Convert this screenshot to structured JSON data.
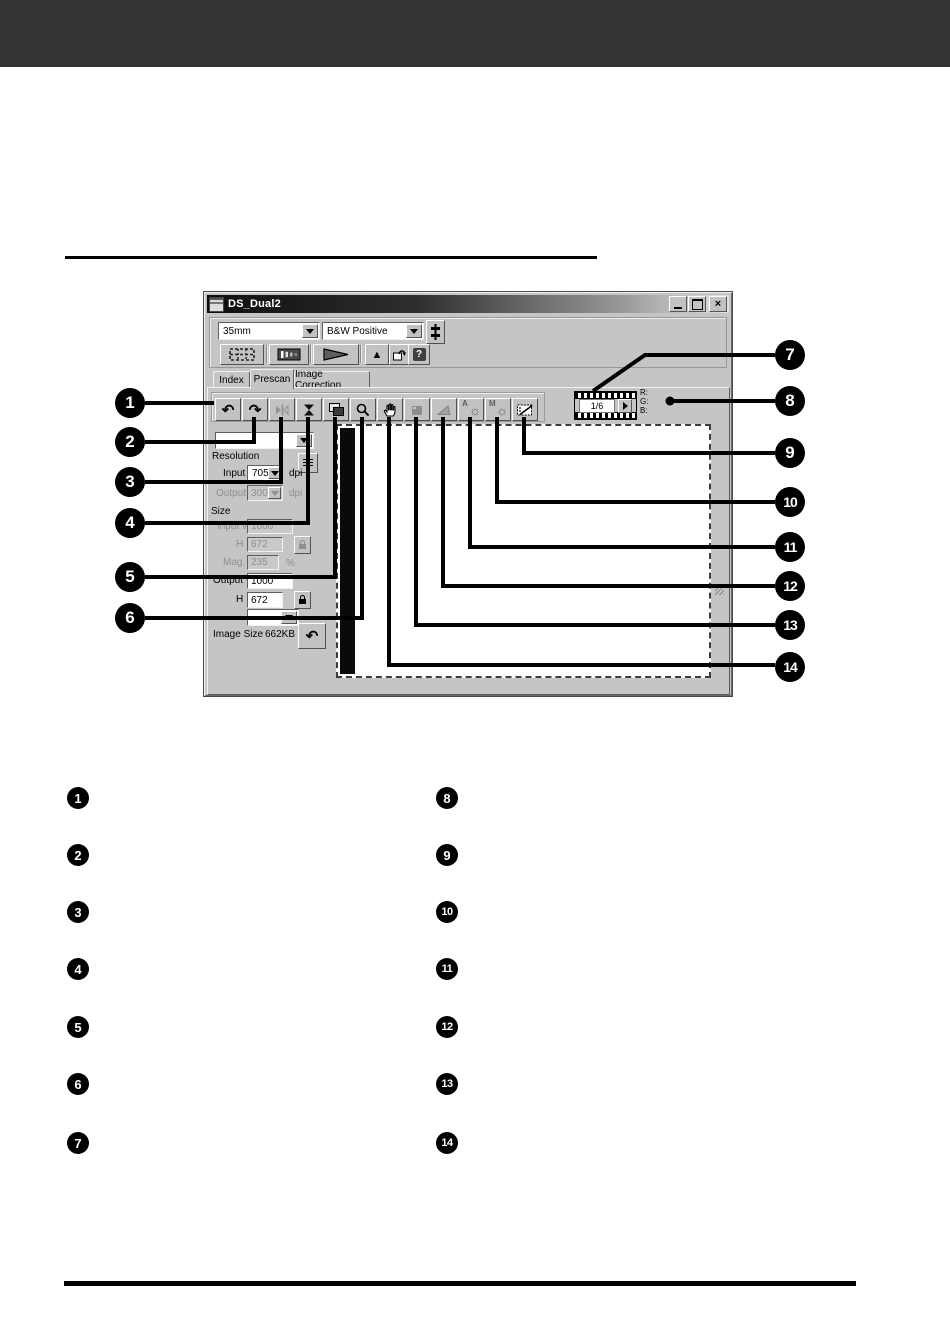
{
  "window": {
    "title": "DS_Dual2",
    "format_combo": "35mm",
    "type_combo": "B&W Positive",
    "tabs": [
      "Index",
      "Prescan",
      "Image Correction"
    ],
    "frame_indicator": "1/6",
    "rgb": [
      "R:",
      "G:",
      "B:"
    ],
    "panel": {
      "resolution": "Resolution",
      "input": "Input",
      "input_value": "705",
      "input_unit": "dpi",
      "output": "Output",
      "output_value": "300",
      "output_unit": "dpi",
      "size": "Size",
      "input_w": "Input W",
      "input_w_value": "1000",
      "input_h": "H",
      "input_h_value": "672",
      "mag": "Mag.",
      "mag_value": "235",
      "mag_unit": "%",
      "output_w": "Output W",
      "output_w_value": "1000",
      "output_h": "H",
      "output_h_value": "672",
      "image_size": "Image Size",
      "image_size_value": "662KB"
    },
    "icons": {
      "rotate_left": "↶",
      "rotate_right": "↷",
      "eject": "▲",
      "help": "?",
      "auto_letter": "A",
      "manual_letter": "M",
      "sun": "☼",
      "undo": "↶"
    }
  },
  "callouts": {
    "numbers": [
      "1",
      "2",
      "3",
      "4",
      "5",
      "6",
      "7",
      "8",
      "9",
      "10",
      "11",
      "12",
      "13",
      "14"
    ]
  }
}
